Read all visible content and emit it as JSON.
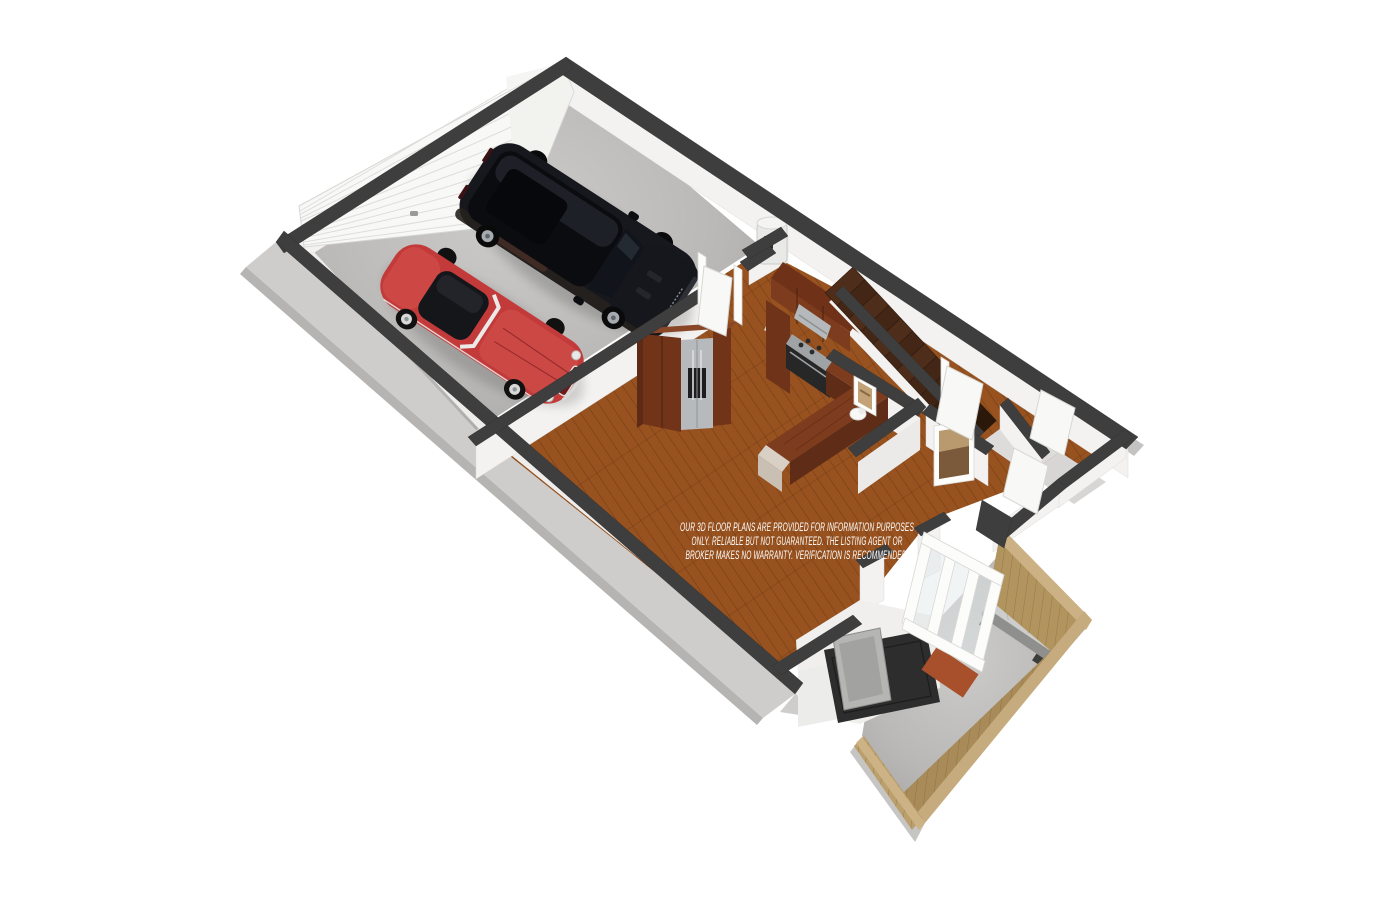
{
  "page": {
    "background": "#ffffff"
  },
  "floorplan": {
    "view": "isometric-3d-render",
    "disclaimer": {
      "line1": "OUR 3D FLOOR PLANS ARE PROVIDED FOR INFORMATION PURPOSES",
      "line2": "ONLY. RELIABLE BUT NOT GUARANTEED. THE LISTING AGENT OR",
      "line3": "BROKER MAKES NO WARRANTY. VERIFICATION IS RECOMMENDED.",
      "color": "#ffffff"
    },
    "rooms": [
      {
        "name": "garage",
        "floor": "concrete"
      },
      {
        "name": "kitchen",
        "floor": "hardwood"
      },
      {
        "name": "living-dining",
        "floor": "hardwood"
      },
      {
        "name": "hallway",
        "floor": "hardwood"
      },
      {
        "name": "bathroom",
        "floor": "hardwood"
      },
      {
        "name": "closet",
        "floor": "hardwood"
      },
      {
        "name": "patio",
        "floor": "concrete"
      }
    ],
    "objects": [
      "red-classic-convertible",
      "black-suv",
      "sectional-garage-door",
      "water-heater",
      "pantry-refrigerator-unit",
      "kitchen-cabinets",
      "range-hood",
      "range-oven",
      "kitchen-peninsula",
      "staircase",
      "framed-artwork-small",
      "framed-artwork-large",
      "toilet",
      "interior-doors",
      "sliding-patio-door",
      "patio-bench",
      "patio-doormat",
      "wood-privacy-fence",
      "media-console-tv"
    ],
    "colors": {
      "wall_top": "#3e3e3e",
      "wall_face": "#f3f2f0",
      "wall_exterior": "#cecdcb",
      "concrete": "#b6b5b3",
      "hardwood": "#97521f",
      "cabinet_wood": "#713419",
      "counter_wood": "#7e3c1e",
      "stair_tread": "#4e2d1a",
      "fence_wood": "#b2945f",
      "marble": "#d9d0c5",
      "stainless": "#b3b6b9",
      "car_red": "#c23a3a",
      "car_black": "#17181d",
      "doormat": "#a8502b",
      "bench_cushion": "#cdcdcb"
    }
  }
}
